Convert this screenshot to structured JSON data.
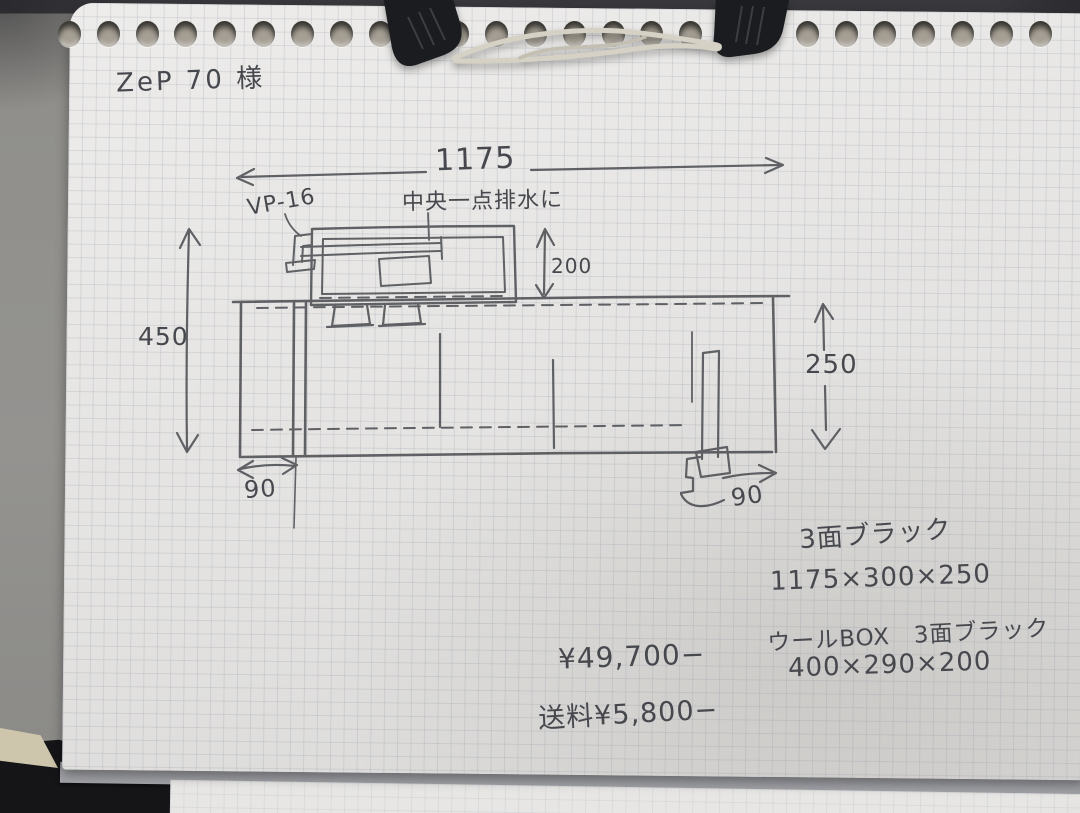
{
  "page": {
    "customer_note": "ZeP 70 様"
  },
  "sketch": {
    "dimensions": {
      "overall_width": "1175",
      "left_height": "450",
      "right_height": "250",
      "wool_box_height": "200",
      "left_offset": "90",
      "right_offset": "90"
    },
    "labels": {
      "pipe": "VP-16",
      "drain_note": "中央一点排水に"
    },
    "specs": [
      "3面ブラック",
      "1175×300×250",
      "ウールBOX　3面ブラック",
      "400×290×200"
    ],
    "price": "¥49,700−",
    "shipping": "送料¥5,800−"
  },
  "colors": {
    "pencil": "#4e4f54",
    "paper": "#e3e2e0",
    "grid": "#828ca2",
    "wall": "#8f8e8a",
    "desk": "#151518",
    "clip_body": "#1b1c1f",
    "clip_wire": "#d5d1c5"
  }
}
